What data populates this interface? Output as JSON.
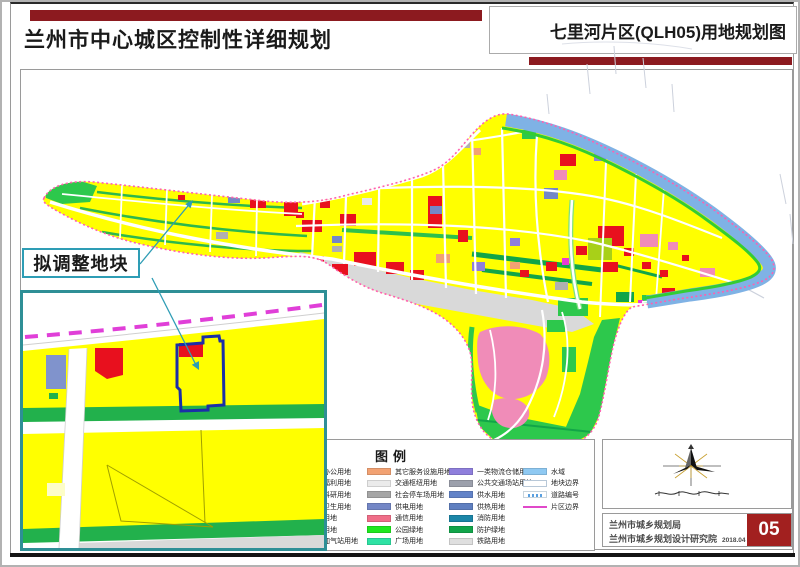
{
  "header": {
    "title_left": "兰州市中心城区控制性详细规划",
    "title_right": "七里河片区(QLH05)用地规划图"
  },
  "callout": {
    "label": "拟调整地块"
  },
  "legend": {
    "title": "图例",
    "columns": [
      {
        "items": [
          {
            "label": "行政办公用地",
            "color": "#f07878"
          },
          {
            "label": "社会福利用地",
            "color": "#f0a0a8"
          },
          {
            "label": "教育科研用地",
            "color": "#f2b6c8"
          },
          {
            "label": "医疗卫生用地",
            "color": "#f2a0b0"
          },
          {
            "label": "文化用地",
            "color": "#f08cb8"
          },
          {
            "label": "商务用地",
            "color": "#f2788c"
          },
          {
            "label": "加油加气站用地",
            "color": "#c8b4e0"
          }
        ]
      },
      {
        "items": [
          {
            "label": "其它服务设施用地",
            "color": "#f2a273"
          },
          {
            "label": "交通枢纽用地",
            "color": "#ebebeb"
          },
          {
            "label": "社会停车场用地",
            "color": "#a6a6a6"
          },
          {
            "label": "供电用地",
            "color": "#7487c6"
          },
          {
            "label": "通信用地",
            "color": "#f06e88"
          },
          {
            "label": "公园绿地",
            "color": "#1fe81f"
          },
          {
            "label": "广场用地",
            "color": "#2ee2a4"
          }
        ]
      },
      {
        "items": [
          {
            "label": "一类物流仓储用地",
            "color": "#8f7fdc"
          },
          {
            "label": "公共交通场站用地",
            "color": "#9ca0ac"
          },
          {
            "label": "供水用地",
            "color": "#6283c8"
          },
          {
            "label": "供热用地",
            "color": "#5f7fc0"
          },
          {
            "label": "消防用地",
            "color": "#1c86a8"
          },
          {
            "label": "防护绿地",
            "color": "#12a54a"
          },
          {
            "label": "铁路用地",
            "color": "#dfdfdf"
          }
        ]
      },
      {
        "items": [
          {
            "label": "水域",
            "color": "#8fc9f2"
          },
          {
            "label": "地块边界",
            "color": "#ffffff"
          },
          {
            "label": "道路编号",
            "color": "#ffffff"
          },
          {
            "label": "片区边界",
            "color": "#e049c9"
          }
        ]
      }
    ]
  },
  "titleblock": {
    "org_line1": "兰州市城乡规划局",
    "org_line2": "兰州市城乡规划设计研究院",
    "date": "2018.04",
    "sheet_number": "05"
  },
  "colors": {
    "header_bar": "#8c1a1f",
    "sheet_number_bg": "#a2201f",
    "residential_yellow": "#ffff00",
    "commercial_red": "#e8101e",
    "park_green": "#2dc84c",
    "protective_green": "#12a54a",
    "river_blue": "#7fb2e5",
    "rail_gray": "#d9d9d9",
    "district_boundary_pink": "#ff5fb0",
    "inset_border_teal": "#2e8f96",
    "plot_outline_blue": "#1b2fa8",
    "boundary_dash_magenta": "#e03fd8"
  }
}
